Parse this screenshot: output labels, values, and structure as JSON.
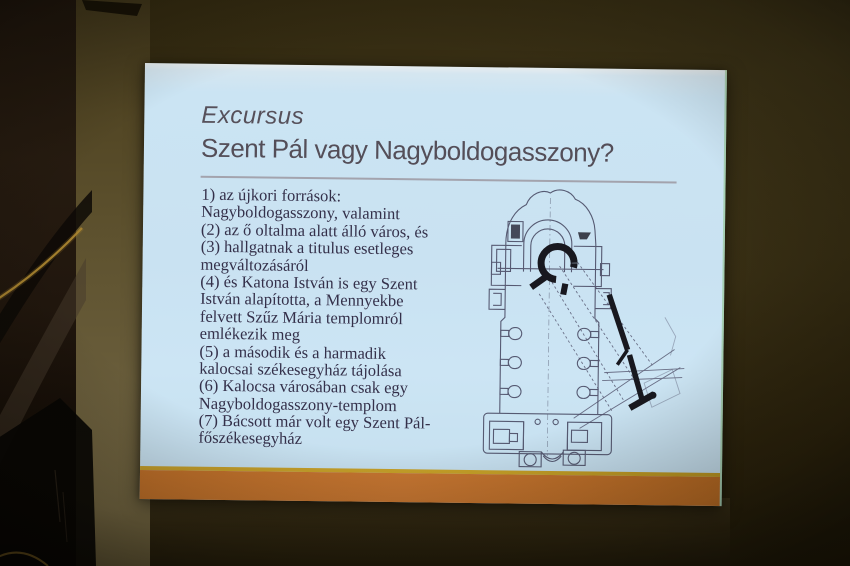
{
  "slide": {
    "title": "Excursus",
    "subtitle": "Szent Pál vagy Nagyboldogasszony?",
    "body_lines": [
      "1) az újkori források:",
      "Nagyboldogasszony, valamint",
      "(2) az ő oltalma alatt álló város, és",
      "(3) hallgatnak a titulus esetleges",
      "megváltozásáról",
      "(4) és Katona István is egy Szent",
      "István alapította, a Mennyekbe",
      "felvett Szűz Mária templomról",
      "emlékezik meg",
      "(5) a második és a harmadik",
      "kalocsai székesegyház tájolása",
      "(6) Kalocsa városában csak egy",
      "Nagyboldogasszony-templom",
      "(7) Bácsott már volt egy Szent Pál-",
      "főszékesegyház"
    ],
    "figure_label": "church-floor-plan",
    "colors": {
      "slide_background": "#cbe4f3",
      "title_text": "#56505a",
      "body_text": "#34304a",
      "accent_bar_gold": "#c8a228",
      "accent_bar_orange": "#c37229",
      "plan_lines": "#42425c",
      "plan_bold": "#18181f"
    }
  }
}
